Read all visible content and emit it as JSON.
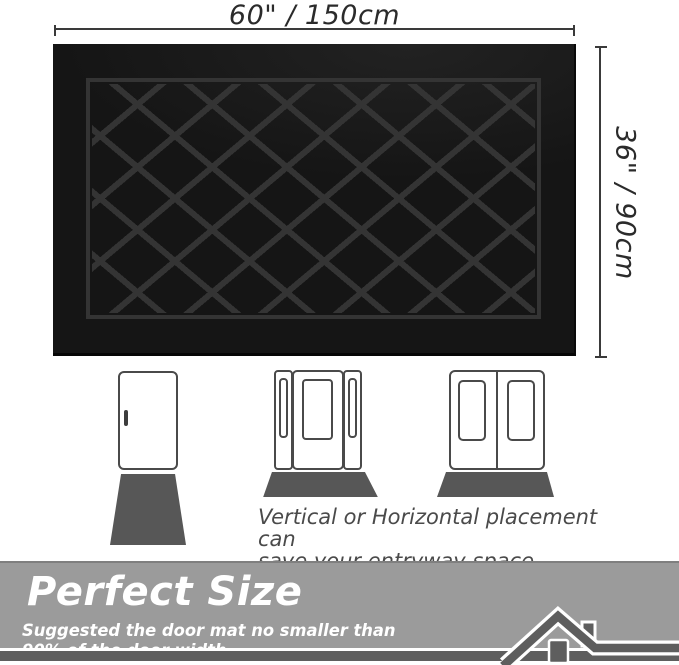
{
  "dimensions": {
    "width_label": "60\" / 150cm",
    "height_label": "36\" / 90cm",
    "line_color": "#3a3a3a"
  },
  "mat": {
    "base_color": "#151515",
    "pattern_color": "#343434",
    "frame_color": "#343434",
    "pattern_style": "diamond-lattice"
  },
  "illustrations": {
    "outline_color": "#4a4a4a",
    "placement_mat_color": "#575757",
    "items": [
      {
        "label": "single-door-vertical-mat"
      },
      {
        "label": "door-with-sidelights-horizontal-mat"
      },
      {
        "label": "double-door-horizontal-mat"
      }
    ],
    "caption_line1": "Vertical or Horizontal placement can",
    "caption_line2": "save your entryway space."
  },
  "banner": {
    "title": "Perfect Size",
    "subtitle": "Suggested the door mat no smaller than 90% of the door width.",
    "background_color": "#9b9b9b",
    "bottom_bar_color": "#5e5e5e",
    "text_color": "#ffffff",
    "icon": "house-roof-icon"
  }
}
